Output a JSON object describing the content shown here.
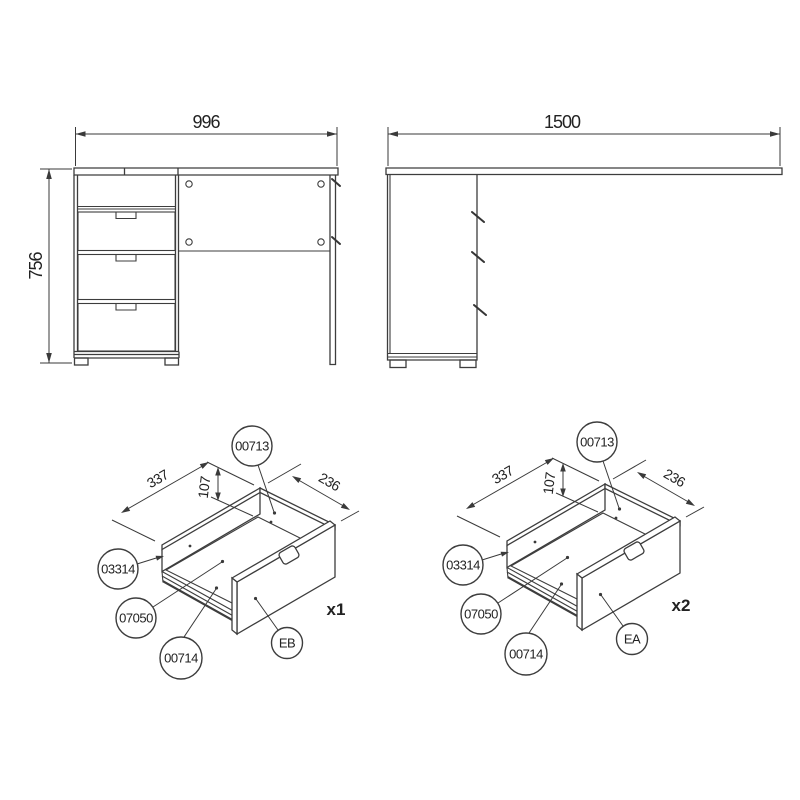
{
  "drawing": {
    "front_view": {
      "width_mm": "996",
      "height_mm": "756"
    },
    "side_view": {
      "depth_mm": "1500"
    },
    "drawer_a": {
      "balloon_back_panel": "00713",
      "balloon_side_panel": "03314",
      "balloon_rail": "07050",
      "balloon_bottom_panel": "00714",
      "balloon_front_panel": "EB",
      "quantity": "x1",
      "width_mm": "337",
      "height_mm": "107",
      "depth_mm": "236"
    },
    "drawer_b": {
      "balloon_back_panel": "00713",
      "balloon_side_panel": "03314",
      "balloon_rail": "07050",
      "balloon_bottom_panel": "00714",
      "balloon_front_panel": "EA",
      "quantity": "x2",
      "width_mm": "337",
      "height_mm": "107",
      "depth_mm": "236"
    }
  },
  "colors": {
    "line": "#3d3d3d",
    "text": "#222222",
    "background": "#ffffff"
  }
}
